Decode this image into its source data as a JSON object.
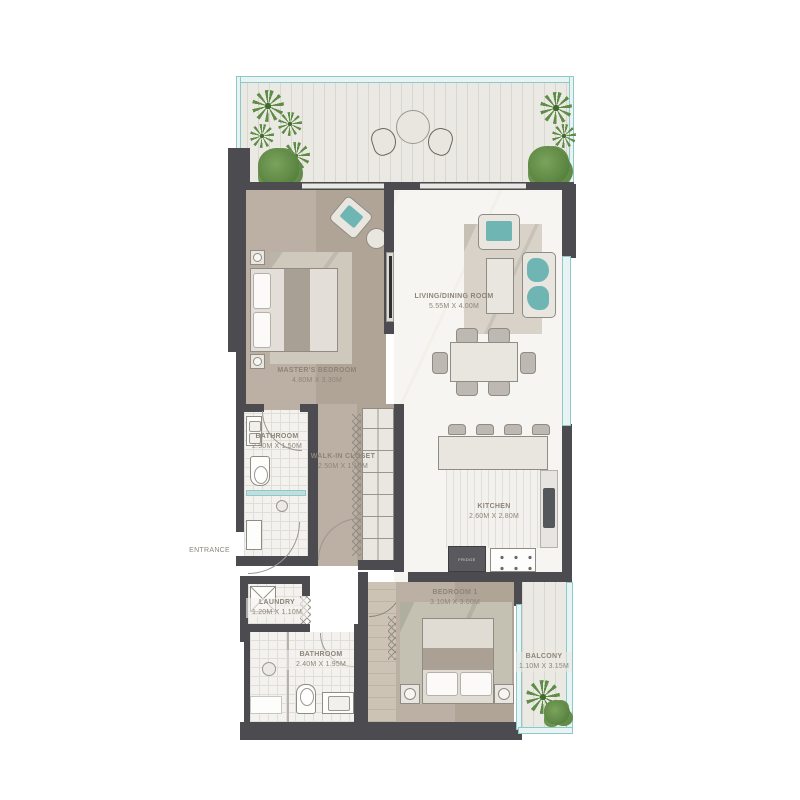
{
  "rooms": {
    "living": {
      "label": "LIVING/DINING ROOM",
      "dims": "5.55M X 4.00M"
    },
    "master": {
      "label": "MASTER'S BEDROOM",
      "dims": "4.80M X 3.30M"
    },
    "bathroom1": {
      "label": "BATHROOM",
      "dims": "2.50M X 1.50M"
    },
    "closet": {
      "label": "WALK-IN CLOSET",
      "dims": "2.50M X 1.10M"
    },
    "kitchen": {
      "label": "KITCHEN",
      "dims": "2.60M X 2.80M"
    },
    "entrance": {
      "label": "ENTRANCE"
    },
    "laundry": {
      "label": "LAUNDRY",
      "dims": "1.20M X 1.10M"
    },
    "bathroom2": {
      "label": "BATHROOM",
      "dims": "2.40M X 1.95M"
    },
    "bedroom1": {
      "label": "BEDROOM 1",
      "dims": "3.10M X 3.00M"
    },
    "balcony": {
      "label": "BALCONY",
      "dims": "1.10M X 3.15M"
    }
  },
  "appliances": {
    "fridge": "FRIDGE"
  },
  "colors": {
    "wall": "#4c4c50",
    "glass": "#8ec9c9",
    "taupe_floor": "#b7ab9d",
    "accent_teal": "#6fb5b4",
    "plant_green": "#5f8c46",
    "label_text": "#8c8579"
  }
}
